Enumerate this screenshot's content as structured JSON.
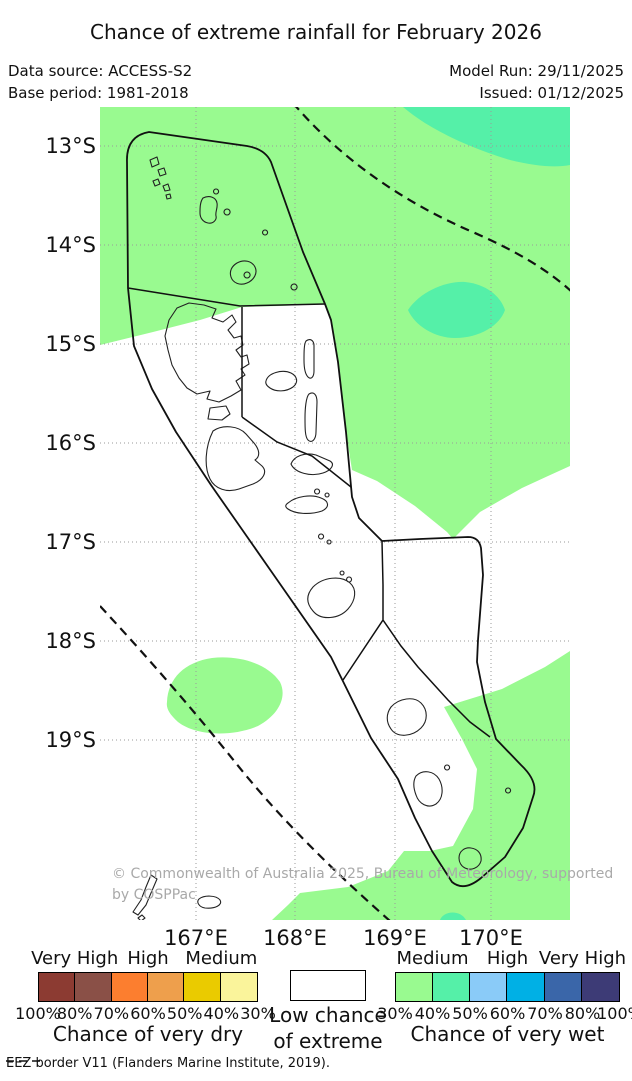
{
  "header": {
    "title": "Chance of extreme rainfall for February 2026",
    "data_source": "Data source: ACCESS-S2",
    "base_period": "Base period: 1981-2018",
    "model_run": "Model Run: 29/11/2025",
    "issued": "Issued: 01/12/2025"
  },
  "map": {
    "y_ticks": [
      {
        "label": "13°S"
      },
      {
        "label": "14°S"
      },
      {
        "label": "15°S"
      },
      {
        "label": "16°S"
      },
      {
        "label": "17°S"
      },
      {
        "label": "18°S"
      },
      {
        "label": "19°S"
      }
    ],
    "x_ticks": [
      {
        "label": "167°E"
      },
      {
        "label": "168°E"
      },
      {
        "label": "169°E"
      },
      {
        "label": "170°E"
      }
    ],
    "watermark": {
      "line1": "© Commonwealth of Australia 2025, Bureau of Meteorology, supported",
      "line2": "by COSPPac"
    }
  },
  "legend": {
    "dry": {
      "caption": "Chance of very dry",
      "levels": [
        "Very High",
        "High",
        "Medium"
      ],
      "percents": [
        "100%",
        "80%",
        "70%",
        "60%",
        "50%",
        "40%",
        "30%"
      ],
      "colors": [
        "#8C3B32",
        "#8A5047",
        "#FC7E2F",
        "#EE9F4C",
        "#EACB00",
        "#FAF49B"
      ]
    },
    "extreme": {
      "line1": "Low chance",
      "line2": "of extreme"
    },
    "wet": {
      "caption": "Chance of very wet",
      "levels": [
        "Medium",
        "High",
        "Very High"
      ],
      "percents": [
        "30%",
        "40%",
        "50%",
        "60%",
        "70%",
        "80%",
        "100%"
      ],
      "colors": [
        "#99FA90",
        "#55F0A8",
        "#8ACBF8",
        "#00B0E5",
        "#3A66A9",
        "#3D3B76"
      ]
    }
  },
  "footer": {
    "eez_label": "EEZ border V11 (Flanders Marine Institute, 2019)."
  },
  "colors": {
    "rain_wet_light": "#99FA90",
    "rain_wet_teal": "#55F0A8",
    "watermark": "#A9A9A9"
  }
}
